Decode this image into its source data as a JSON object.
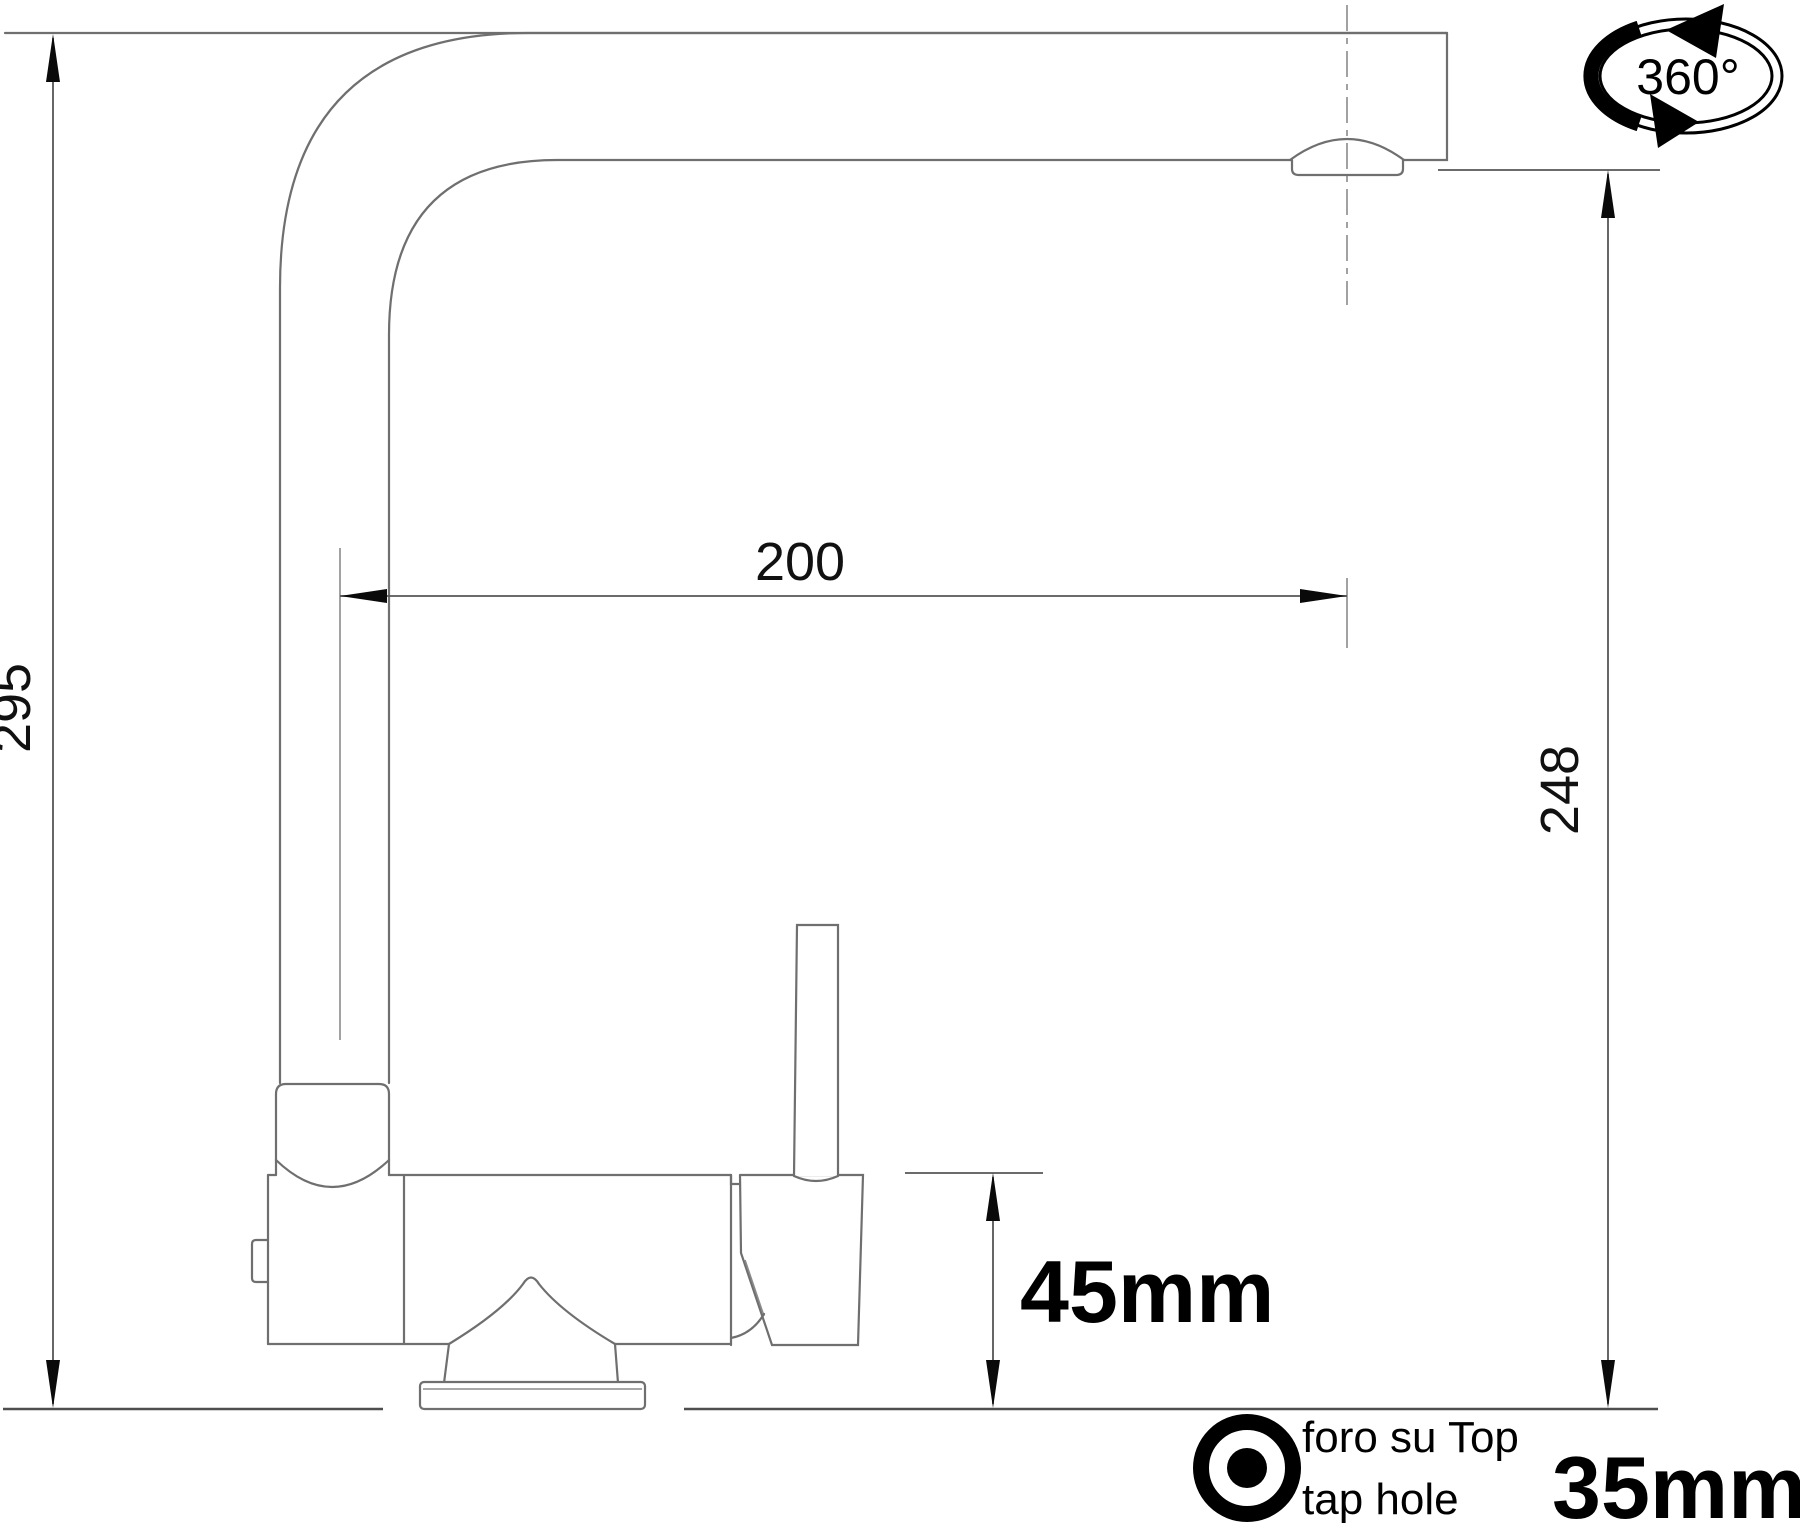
{
  "dimensions": {
    "total_height": "295",
    "spout_reach": "200",
    "outlet_height": "248",
    "body_height": "45mm",
    "tap_hole_diameter": "35mm"
  },
  "labels": {
    "rotation": "360°",
    "tap_hole_line1": "foro su Top",
    "tap_hole_line2": "tap hole"
  },
  "colors": {
    "background": "#ffffff",
    "outline_gray": "#6f6f6f",
    "dimension_gray": "#565656",
    "ink_black": "#000000"
  }
}
